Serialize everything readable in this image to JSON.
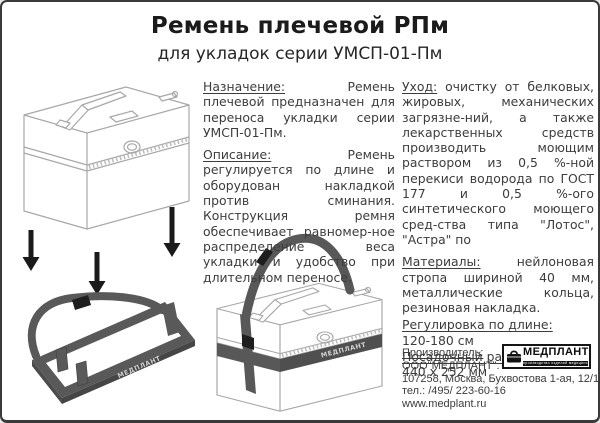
{
  "header": {
    "title": "Ремень плечевой РПм",
    "subtitle": "для укладок серии УМСП-01-Пм"
  },
  "sections": {
    "purpose": {
      "label": "Назначение:",
      "text": "Ремень плечевой предназначен для переноса укладки серии УМСП-01-Пм."
    },
    "description": {
      "label": "Описание:",
      "text": "Ремень регулируется по длине и оборудован накладкой против сминания. Конструкция ремня обеспечивает равномер-ное распределение веса укладки и удобство при длительном переносе."
    },
    "care": {
      "label": "Уход:",
      "text": "очистку от белковых, жировых, механических загрязне-ний, а также лекарственных средств производить моющим раствором из 0,5 %-ной перекиси водорода по ГОСТ 177 и 0,5 %-ого синтетического моющего сред-ства типа \"Лотос\", \"Астра\" по"
    },
    "materials": {
      "label": "Материалы:",
      "text": "нейлоновая стропа шириной 40 мм, металлические кольца, резиновая накладка."
    },
    "length_adjustment": {
      "label": "Регулировка по длине:",
      "value": "120-180 см"
    },
    "seat_size": {
      "label": "Посадочный размер:",
      "value": "440 х 252 мм"
    }
  },
  "manufacturer": {
    "label": "Производитель:",
    "company": "ООО\"МЕДПЛАНТ\".",
    "address": "107258, Москва, Бухвостова 1-ая, 12/11",
    "phone": "тел.: /495/ 223-60-16",
    "website": "www.medplant.ru"
  },
  "logo": {
    "name": "МЕДПЛАНТ",
    "tagline": "производство изделий медицинского назначения"
  },
  "drawings": {
    "strap_brand": "МЕДПЛАНТ"
  },
  "colors": {
    "strap": "#595959",
    "arrow": "#1a1a1a",
    "case_outline": "#a8a8a8",
    "page_border": "#3a3a3a"
  }
}
